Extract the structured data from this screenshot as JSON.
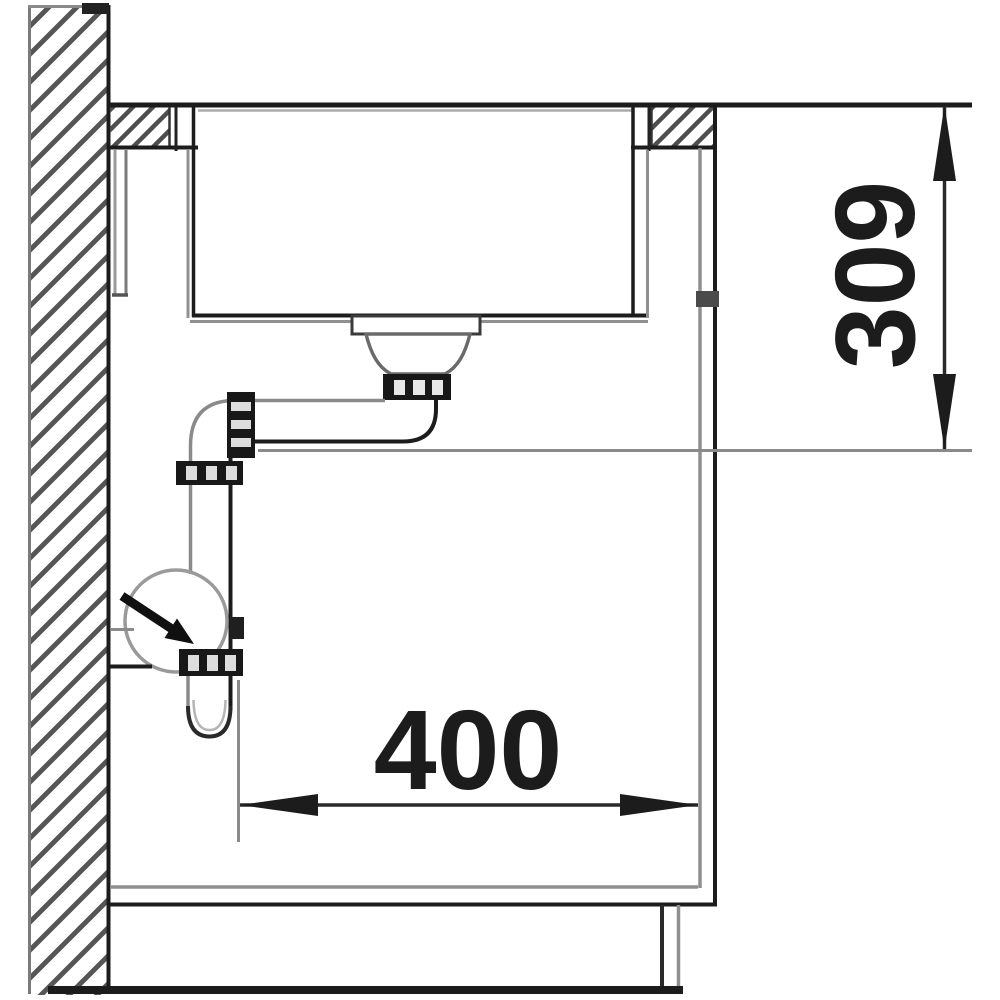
{
  "diagram": {
    "type": "technical-drawing",
    "subject": "Kitchen sink side-section installation drawing with siphon drain",
    "dimensions": [
      {
        "name": "bowl-depth",
        "value": "309",
        "orientation": "vertical",
        "position": "right"
      },
      {
        "name": "drain-offset-width",
        "value": "400",
        "orientation": "horizontal",
        "position": "bottom"
      }
    ],
    "components": [
      "hatched-wall",
      "countertop",
      "undermount-sink-bowl",
      "drain-strainer",
      "drain-pipe",
      "siphon-trap",
      "flow-direction-arrow",
      "cabinet-side-panel",
      "cabinet-bottom-panel",
      "plinth",
      "floor-line"
    ],
    "colors": {
      "line_dark": "#1c1c1c",
      "line_gray": "#8f8f8f",
      "hatch": "#565656",
      "background": "#ffffff"
    }
  }
}
